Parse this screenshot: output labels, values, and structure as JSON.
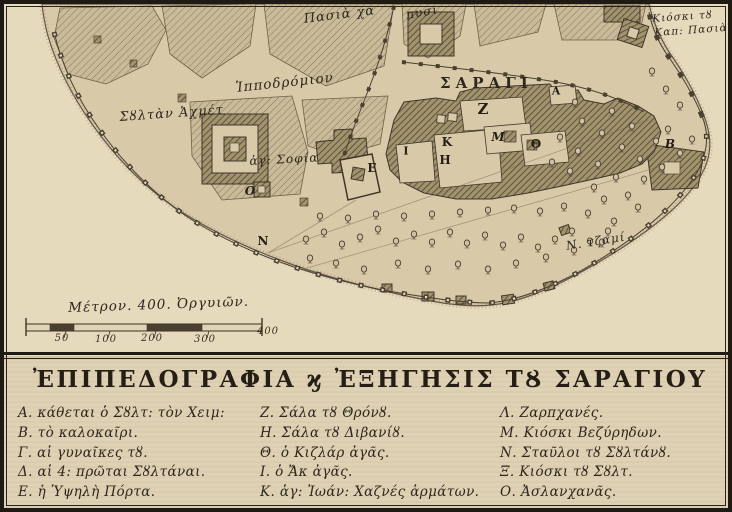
{
  "map": {
    "place_labels": [
      {
        "text": "Πασιὰ χα"
      },
      {
        "text": "πυσι"
      },
      {
        "text": "Ἱπποδρόμιον"
      },
      {
        "text": "Σȣλτὰν Ἀχμέτ"
      },
      {
        "text": "ἁγ: Σοφία"
      },
      {
        "text": "ΣΑΡΑΓΙ"
      },
      {
        "text": "Κιόσκι τȣ"
      },
      {
        "text": "Καπ: Πασιὰ"
      },
      {
        "text": "Ν. τζαμί"
      }
    ],
    "building_letters": [
      {
        "ch": "Α"
      },
      {
        "ch": "Β"
      },
      {
        "ch": "Ε"
      },
      {
        "ch": "Ζ"
      },
      {
        "ch": "Η"
      },
      {
        "ch": "Θ"
      },
      {
        "ch": "Ι"
      },
      {
        "ch": "Κ"
      },
      {
        "ch": "Μ"
      },
      {
        "ch": "Ν"
      },
      {
        "ch": "Ο"
      }
    ],
    "scale": {
      "caption": "Μέτρον. 400. Ὀργυιῶν.",
      "ticks": [
        "50",
        "100",
        "200",
        "300",
        "400"
      ]
    }
  },
  "legend": {
    "title": "ἘΠΙΠΕΔΟΓΡΑΦΙΑ ϗ ἘΞΗΓΗΣΙΣ ΤȢ ΣΑΡΑΓΙΟΥ",
    "columns": [
      [
        "Α. κάθεται ὁ Σȣλτ: τὸν Χειμ:",
        "Β. τὸ καλοκαῖρι.",
        "Γ. αἱ γυναῖκες τȣ.",
        "Δ. αἱ 4: πρῶται Σȣλτάναι.",
        "Ε. ἡ Ὑψηλὴ Πόρτα."
      ],
      [
        "Ζ. Σάλα τȣ Θρόνȣ.",
        "Η. Σάλα τȣ Διβανίȣ.",
        "Θ. ὁ Κιζλάρ ἀγᾶς.",
        "Ι. ὁ Ἄκ ἀγᾶς.",
        "Κ. ἁγ: Ἰωάν: Χαζνές ἁρμάτων."
      ],
      [
        "Λ. Ζαρπχανές.",
        "Μ. Κιόσκι Βεζύρηδων.",
        "Ν. Σταῦλοι τȣ Σȣλτάνȣ.",
        "Ξ. Κιόσκι τȣ Σȣλτ.",
        "Ο. Ἀσλανχανᾶς."
      ]
    ]
  }
}
